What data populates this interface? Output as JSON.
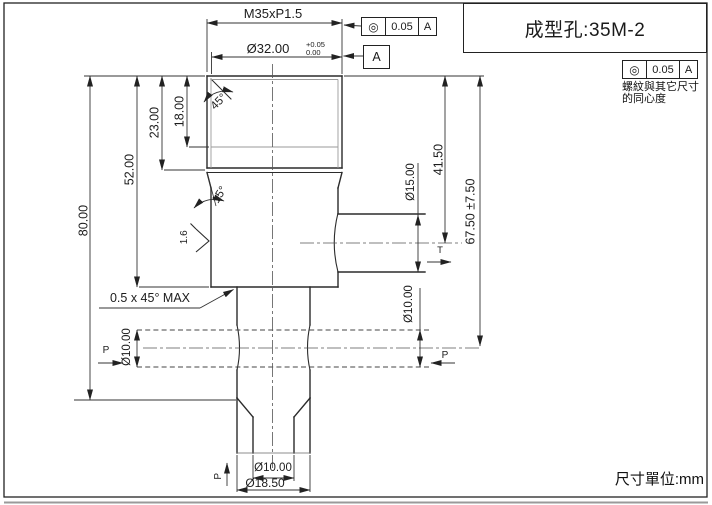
{
  "title_block": {
    "part_label": "成型孔:35M-2"
  },
  "footer": {
    "units_label": "尺寸單位:mm"
  },
  "tolerance_frames": {
    "top": {
      "symbol": "◎",
      "symbol_name": "concentricity",
      "tolerance": "0.05",
      "datum": "A"
    },
    "side": {
      "symbol": "◎",
      "symbol_name": "concentricity",
      "tolerance": "0.05",
      "datum": "A",
      "note_line1": "螺紋與其它尺寸",
      "note_line2": "的同心度"
    }
  },
  "datum_flag": {
    "label": "A"
  },
  "dimensions": {
    "thread": "M35xP1.5",
    "outer_diameter": "Ø32.00",
    "outer_diameter_tol_upper": "+0.05",
    "outer_diameter_tol_lower": "0.00",
    "height_overall": "80.00",
    "height_body": "52.00",
    "depth_thread_full": "23.00",
    "depth_thread": "18.00",
    "chamfer_angle": "45°",
    "taper_angle": "15°",
    "height_to_side_hole": "41.50",
    "side_hole_diameter": "Ø15.00",
    "height_with_tol": "67.50 ±7.50",
    "cross_hole_diameter_left": "Ø10.00",
    "cross_hole_diameter_right": "Ø10.00",
    "bottom_hole_diameter": "Ø10.00",
    "bottom_outer_diameter": "Ø18.50"
  },
  "annotations": {
    "surface_finish": "1.6",
    "chamfer_note": "0.5 x 45° MAX"
  },
  "section_marks": {
    "p_left": "P",
    "p_right": "P",
    "p_bottom": "P",
    "t_right": "T"
  }
}
